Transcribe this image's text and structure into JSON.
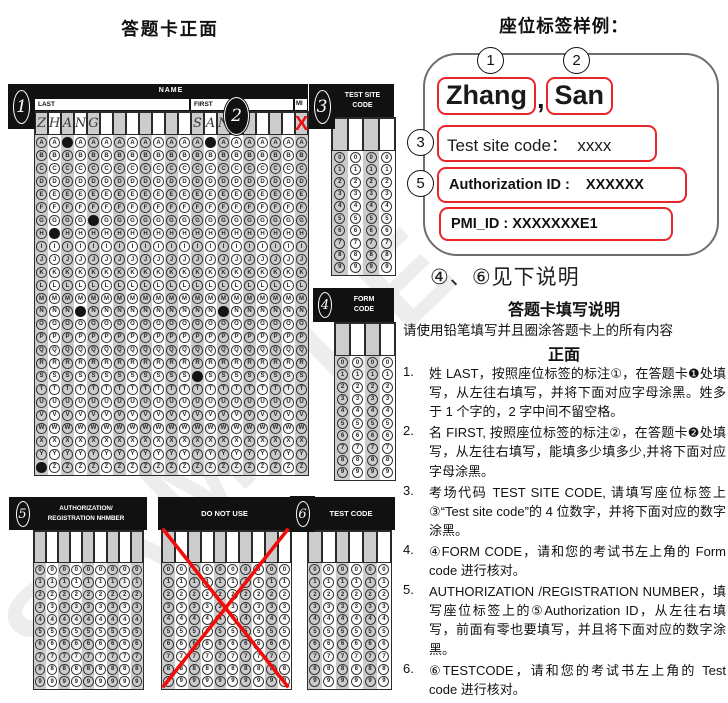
{
  "page": {
    "title_left": "答题卡正面",
    "title_right": "座位标签样例：",
    "watermark": "SAMPLE"
  },
  "sheet": {
    "grids": {
      "name": {
        "header": "NAME",
        "label_last": "LAST",
        "label_first": "FIRST",
        "label_mi": "MI",
        "badge": "1",
        "badge_first": "2",
        "badge_site": "3",
        "cols": 21,
        "symbols": "ABCDEFGHIJKLMNOPQRSTUVWXYZ",
        "write": {
          "0": "Z",
          "1": "H",
          "2": "A",
          "3": "N",
          "4": "G",
          "12": "S",
          "13": "A",
          "14": "N"
        },
        "filled": {
          "0": "Z",
          "1": "H",
          "2": "A",
          "3": "N",
          "4": "G",
          "12": "S",
          "13": "A",
          "14": "N"
        },
        "red_x_col": 20
      },
      "test_site": {
        "header_line1": "TEST SITE",
        "header_line2": "CODE",
        "cols": 4,
        "symbols": "0123456789"
      },
      "form": {
        "header_line1": "FORM",
        "header_line2": "CODE",
        "badge": "4",
        "cols": 4,
        "symbols": "0123456789"
      },
      "auth": {
        "header_line1": "AUTHORIZATION/",
        "header_line2": "REGISTRATION NHMBER",
        "badge": "5",
        "cols": 9,
        "symbols": "0123456789"
      },
      "dnu": {
        "header": "DO NOT USE",
        "cols": 10,
        "symbols": "0123456789",
        "crossed_out": true
      },
      "test_code": {
        "header": "TEST CODE",
        "badge": "6",
        "cols": 6,
        "symbols": "0123456789"
      }
    }
  },
  "seat_label": {
    "callout_last": "1",
    "callout_first": "2",
    "callout_site": "3",
    "callout_auth": "5",
    "last_name": "Zhang",
    "comma": ",",
    "first_name": "San",
    "test_site_code": "Test site code：  xxxx",
    "authorization_id": "Authorization ID :    XXXXXX",
    "pmi_id": "PMI_ID : XXXXXXXE1",
    "note_below": "④、⑥见下说明"
  },
  "instructions": {
    "title": "答题卡填写说明",
    "lead": "请使用铅笔填写并且圈涂答题卡上的所有内容",
    "section": "正面",
    "items": [
      {
        "num": "1.",
        "text": "姓 LAST，按照座位标签的标注①，在答题卡❶处填写，从左往右填写，并将下面对应字母涂黑。姓多于 1 个字的，2 字中间不留空格。"
      },
      {
        "num": "2.",
        "text": "名 FIRST, 按照座位标签的标注②，在答题卡❷处填写，从左往右填写，能填多少填多少,并将下面对应字母涂黑。"
      },
      {
        "num": "3.",
        "text": "考场代码 TEST SITE CODE, 请填写座位标签上③“Test site code”的 4 位数字，并将下面对应的数字涂黑。"
      },
      {
        "num": "4.",
        "text": "④FORM CODE，请和您的考试书左上角的 Form code 进行核对。"
      },
      {
        "num": "5.",
        "text": "AUTHORIZATION /REGISTRATION NUMBER，填写座位标签上的⑤Authorization ID，从左往右填写，前面有零也要填写，并且将下面对应的数字涂黑。"
      },
      {
        "num": "6.",
        "text": "⑥TESTCODE，请和您的考试书左上角的 Test code 进行核对。"
      }
    ]
  },
  "colors": {
    "accent_red": "#e8262a",
    "cross_red": "#f20c0c",
    "header_bg": "#111111",
    "column_stripe": "#cccccc",
    "bubble_fill": "#151515"
  }
}
